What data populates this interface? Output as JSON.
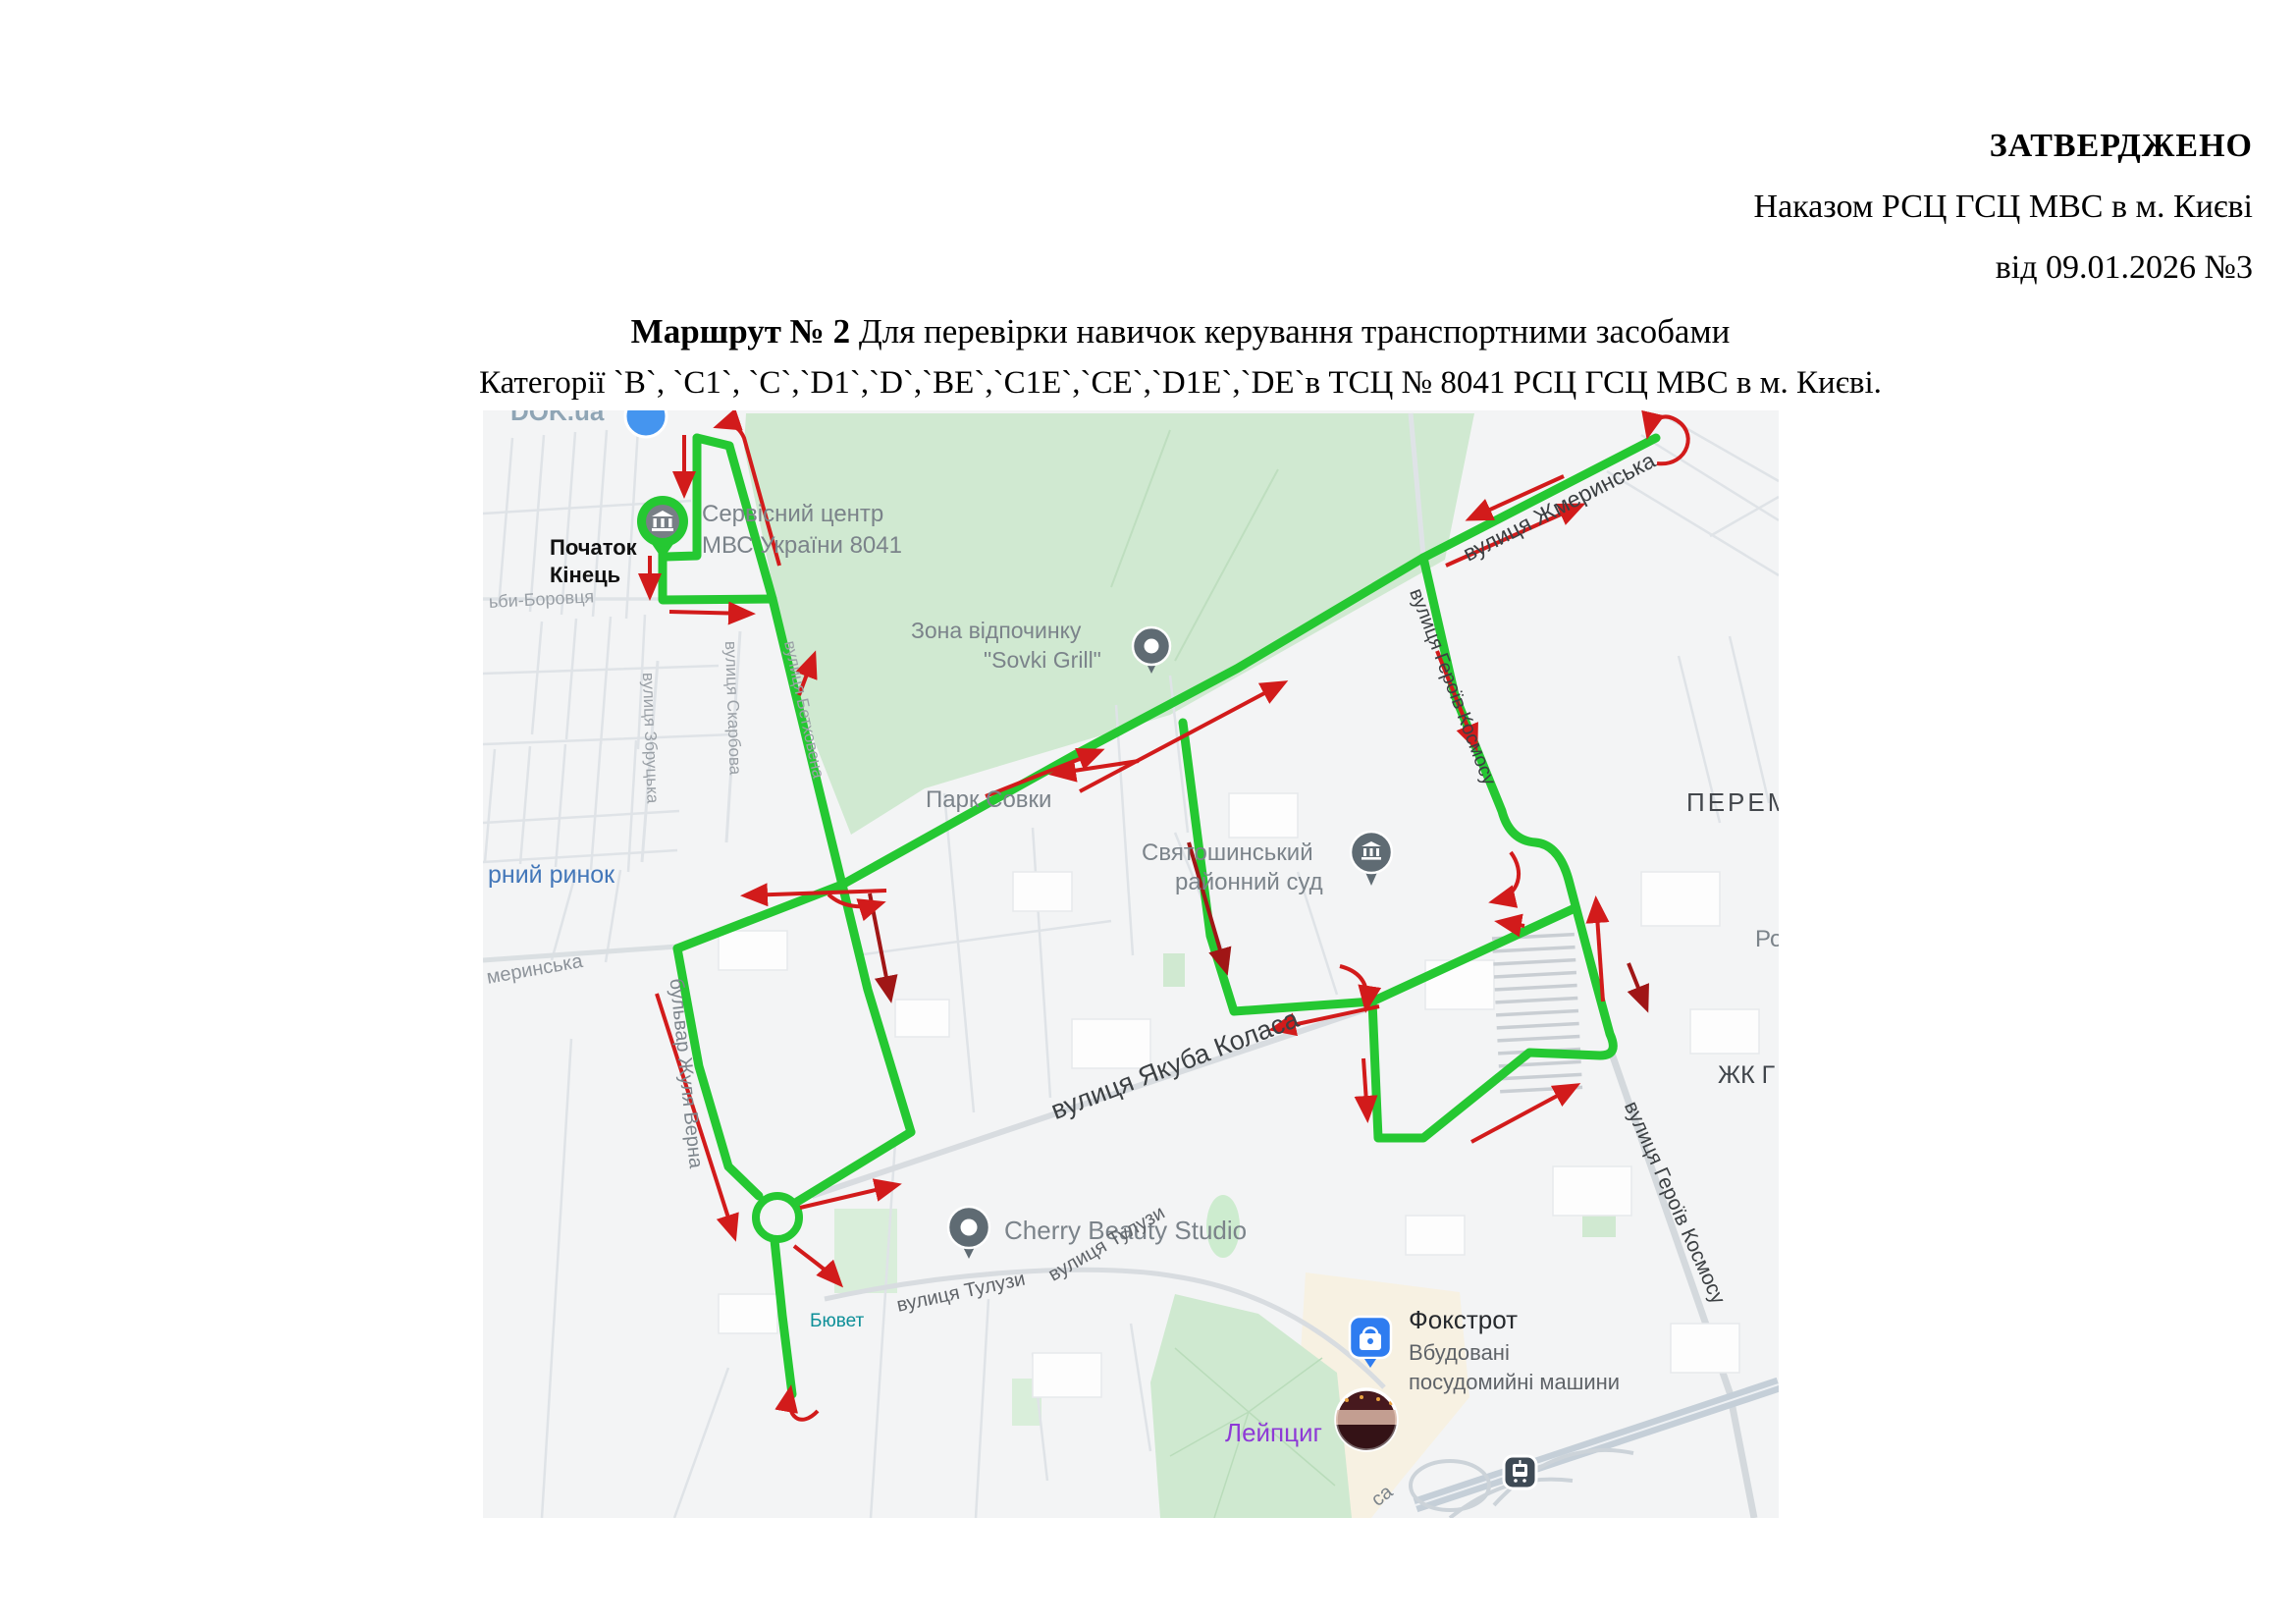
{
  "approval": {
    "line1": "ЗАТВЕРДЖЕНО",
    "line2": "Наказом РСЦ ГСЦ МВС в м. Києві",
    "line3": "від 09.01.2026 №3"
  },
  "title": {
    "bold": "Маршрут № 2",
    "rest": " Для перевірки навичок керування транспортними засобами",
    "line2": "Категорії `B`, `C1`, `C`,`D1`,`D`,`BE`,`C1E`,`CE`,`D1E`,`DE`в ТСЦ № 8041 РСЦ ГСЦ МВС в м. Києві."
  },
  "map": {
    "colors": {
      "route_green": "#25c832",
      "arrow_red": "#d21b1b",
      "arrow_dark_red": "#a01616",
      "park_green": "#d0e9d1",
      "background": "#f3f4f5",
      "poi_gray_pin": "#5f6b73",
      "foxtrot_blue": "#2e7cf0",
      "leipzig_purple": "#8e3ad6",
      "byuvet_teal": "#0d8f98",
      "rynok_blue": "#4377b9"
    },
    "labels": {
      "dok": "DOK.ua",
      "start1": "Початок",
      "start2": "Кінець",
      "service1": "Сервісний центр",
      "service2": "МВС України 8041",
      "borovtsia": "ьби-Боровця",
      "zbrutska": "вулиця Збруцька",
      "skarbova": "вулиця Скарбова",
      "betkhovena": "вулиця Бетховена",
      "zona1": "Зона відпочинку",
      "zona2": "\"Sovki Grill\"",
      "park": "Парк Совки",
      "court1": "Святошинський",
      "court2": "районний суд",
      "rynok": "рний ринок",
      "zhmerynska_left": "меринська",
      "bulvar": "бульвар Жуля Верна",
      "zhmerynska": "вулиця Жмеринська",
      "geroiv_upper": "вулиця Героїв Космосу",
      "perem": "ПЕРЕМ",
      "ro": "Ро",
      "zhk": "ЖК Г",
      "geroiv_lower": "вулиця Героїв Космосу",
      "yakuba": "вулиця Якуба Коласа",
      "cherry": "Cherry Beauty Studio",
      "tuluzy1": "вулиця Тулузи",
      "tuluzy2": "вулиця Тулузи",
      "biuvet": "Бювет",
      "fokstrot": "Фокстрот",
      "fokstrot2": "Вбудовані",
      "fokstrot3": "посудомийні машини",
      "leipzig": "Лейпциг",
      "sa": "са"
    },
    "icons": [
      "start-end-marker-icon",
      "dok-pin-icon",
      "sovki-grill-pin-icon",
      "court-pin-icon",
      "cherry-pin-icon",
      "foxtrot-shopping-icon",
      "tram-station-icon",
      "place-photo-thumbnail"
    ]
  }
}
